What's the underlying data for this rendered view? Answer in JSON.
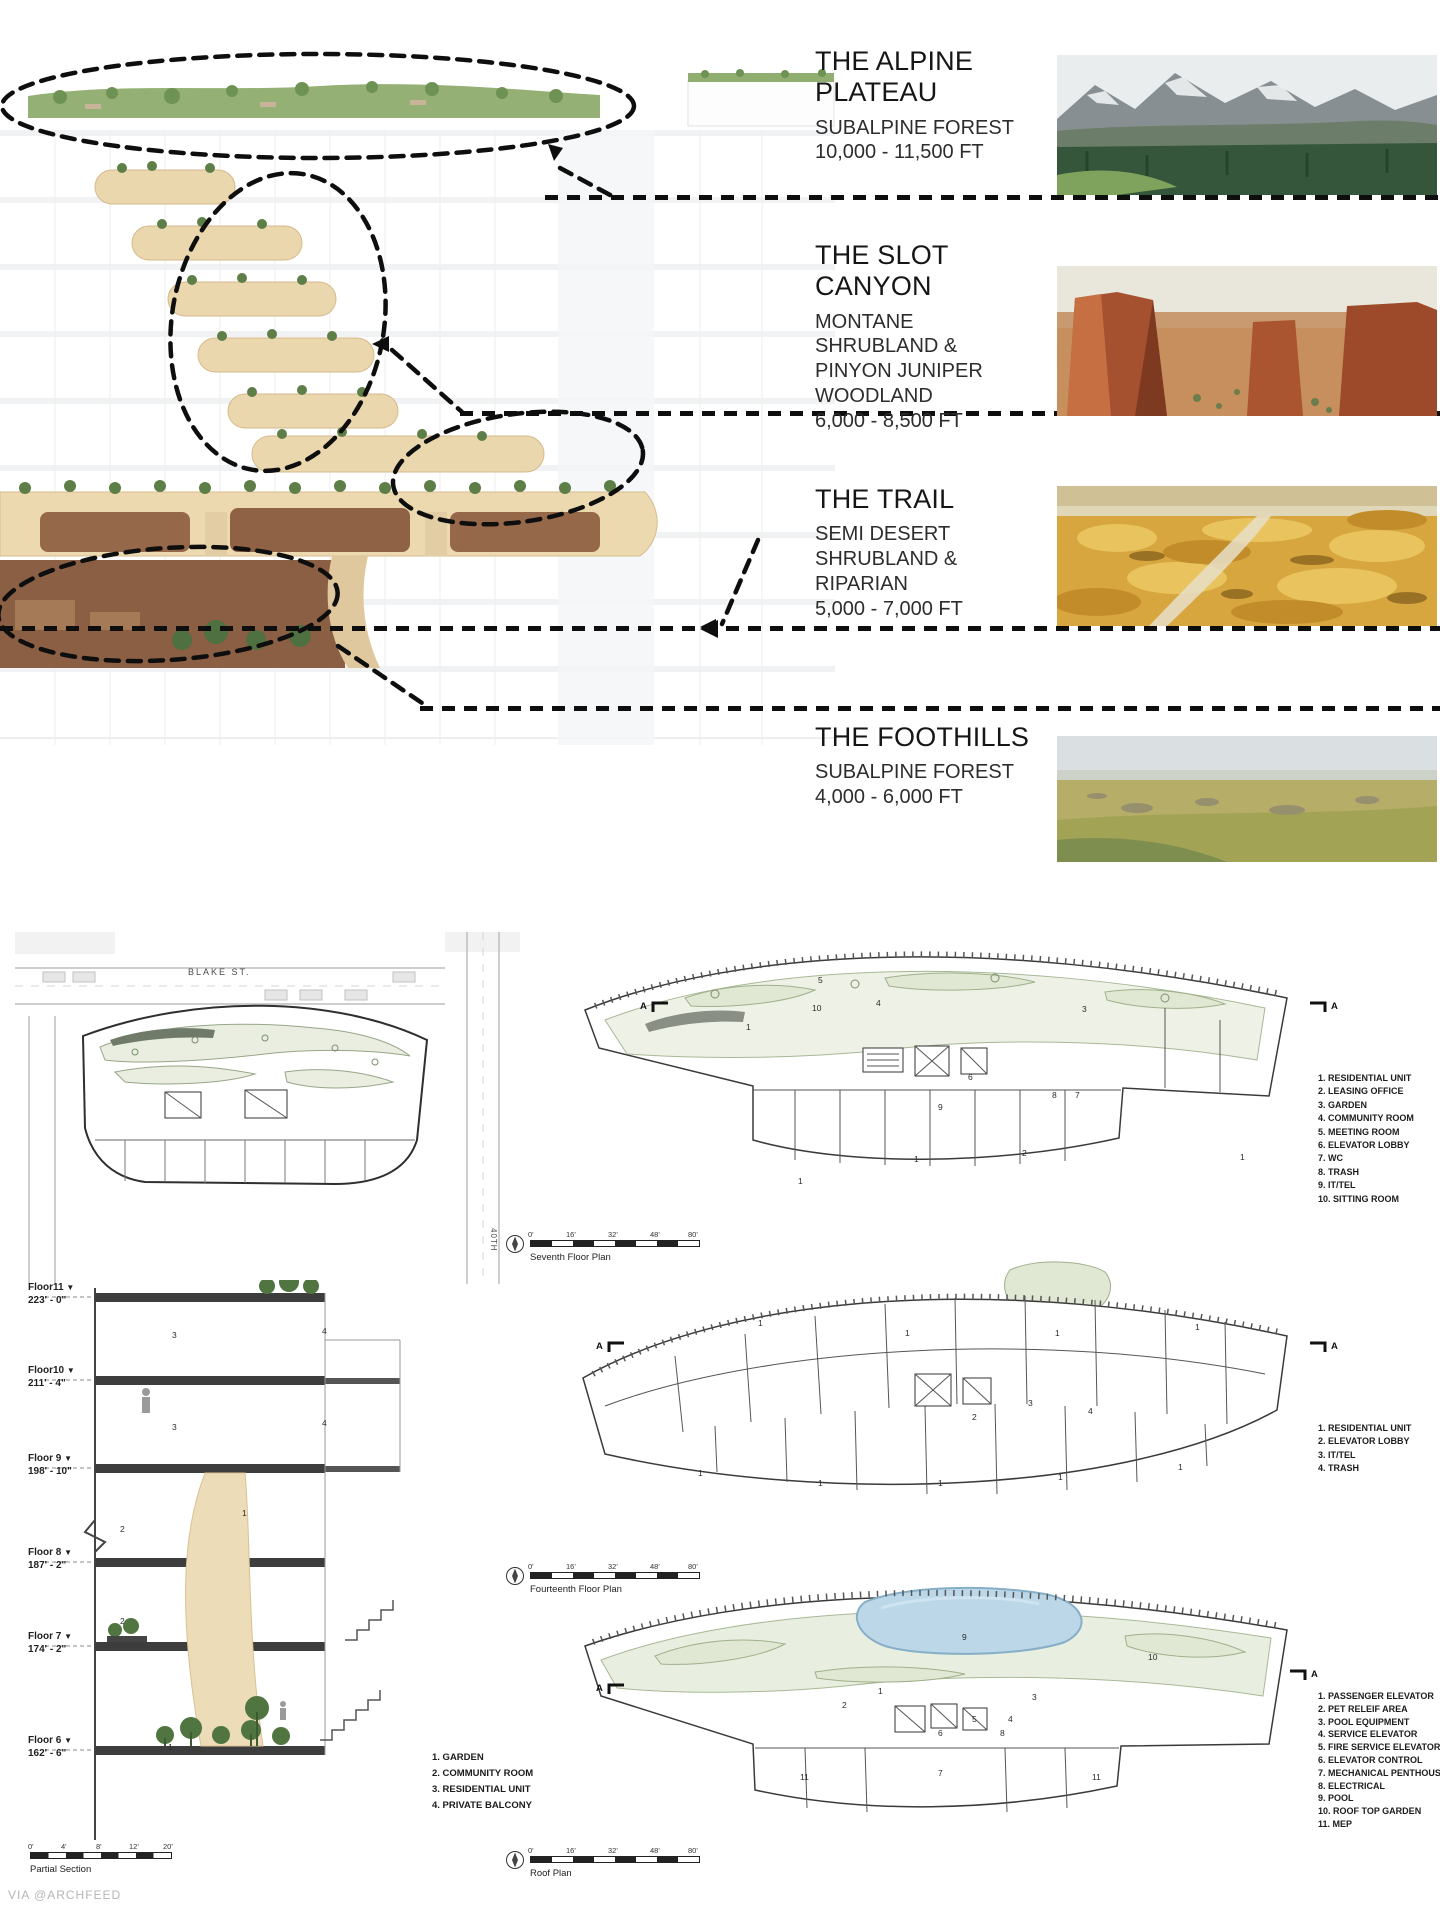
{
  "watermark": "VIA @ARCHFEED",
  "section_marker": "A",
  "palette": {
    "canyon_tan": "#ead7ae",
    "vegetation_green": "#5d7e47",
    "pool_blue": "#bcd8e8",
    "leader_black": "#0e0e0e"
  },
  "zones": [
    {
      "title": "THE ALPINE PLATEAU",
      "subtitle": "SUBALPINE FOREST",
      "elevation": "10,000 - 11,500 FT",
      "photo": "alpine-mountain-forest"
    },
    {
      "title": "THE SLOT CANYON",
      "subtitle": "MONTANE SHRUBLAND & PINYON JUNIPER WOODLAND",
      "elevation": "6,000 - 8,500 FT",
      "photo": "red-rock-canyon"
    },
    {
      "title": "THE TRAIL",
      "subtitle": "SEMI DESERT SHRUBLAND & RIPARIAN",
      "elevation": "5,000 - 7,000 FT",
      "photo": "golden-shrubland"
    },
    {
      "title": "THE FOOTHILLS",
      "subtitle": "SUBALPINE FOREST",
      "elevation": "4,000 - 6,000 FT",
      "photo": "grassland-foothills"
    }
  ],
  "site_plan": {
    "street_top": "BLAKE ST.",
    "street_right": "40TH"
  },
  "section": {
    "title": "Partial Section",
    "floors": [
      {
        "name": "Floor11",
        "elev": "223' - 0\""
      },
      {
        "name": "Floor10",
        "elev": "211' - 4\""
      },
      {
        "name": "Floor 9",
        "elev": "198' - 10\""
      },
      {
        "name": "Floor 8",
        "elev": "187' - 2\""
      },
      {
        "name": "Floor 7",
        "elev": "174' - 2\""
      },
      {
        "name": "Floor 6",
        "elev": "162' - 6\""
      }
    ],
    "legend": [
      "1. GARDEN",
      "2. COMMUNITY ROOM",
      "3. RESIDENTIAL UNIT",
      "4. PRIVATE BALCONY"
    ],
    "scale_ticks": [
      "0'",
      "4'",
      "8'",
      "12'",
      "20'"
    ],
    "numbers": [
      "3",
      "4",
      "3",
      "4",
      "2",
      "1",
      "2",
      "1"
    ]
  },
  "plans": [
    {
      "title": "Seventh Floor Plan",
      "scale_ticks": [
        "0'",
        "16'",
        "32'",
        "48'",
        "80'"
      ],
      "legend": [
        "1. RESIDENTIAL UNIT",
        "2. LEASING OFFICE",
        "3. GARDEN",
        "4. COMMUNITY ROOM",
        "5. MEETING ROOM",
        "6. ELEVATOR LOBBY",
        "7. WC",
        "8. TRASH",
        "9. IT/TEL",
        "10. SITTING ROOM"
      ],
      "numbers": [
        "5",
        "10",
        "4",
        "3",
        "1",
        "6",
        "9",
        "8",
        "7",
        "2",
        "1",
        "1",
        "1"
      ]
    },
    {
      "title": "Fourteenth Floor Plan",
      "scale_ticks": [
        "0'",
        "16'",
        "32'",
        "48'",
        "80'"
      ],
      "legend": [
        "1. RESIDENTIAL UNIT",
        "2. ELEVATOR LOBBY",
        "3. IT/TEL",
        "4. TRASH"
      ],
      "numbers": [
        "1",
        "1",
        "1",
        "1",
        "2",
        "3",
        "4",
        "1",
        "1",
        "1",
        "1",
        "1"
      ]
    },
    {
      "title": "Roof Plan",
      "scale_ticks": [
        "0'",
        "16'",
        "32'",
        "48'",
        "80'"
      ],
      "legend": [
        "1. PASSENGER ELEVATOR",
        "2. PET RELEIF AREA",
        "3. POOL EQUIPMENT",
        "4. SERVICE ELEVATOR",
        "5. FIRE SERVICE ELEVATOR",
        "6. ELEVATOR CONTROL",
        "7. MECHANICAL PENTHOUSE",
        "8. ELECTRICAL",
        "9. POOL",
        "10. ROOF TOP GARDEN",
        "11. MEP"
      ],
      "numbers": [
        "9",
        "10",
        "1",
        "2",
        "3",
        "5",
        "4",
        "6",
        "8",
        "7",
        "11",
        "11"
      ]
    }
  ]
}
